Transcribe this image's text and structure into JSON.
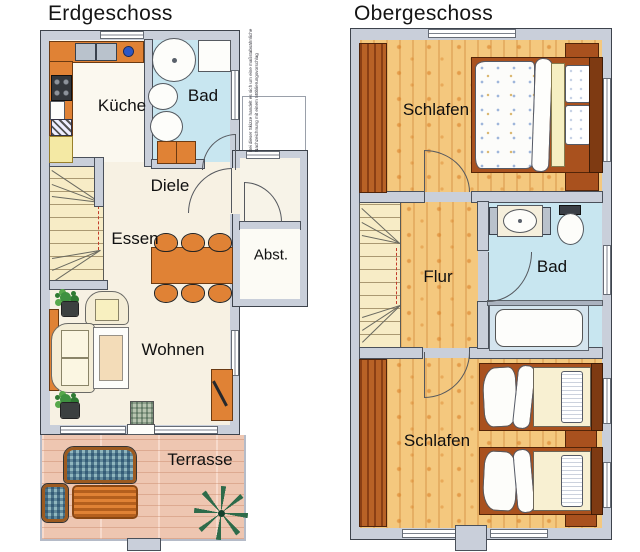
{
  "erdgeschoss": {
    "title": "Erdgeschoss",
    "rooms": {
      "kueche": "Küche",
      "bad": "Bad",
      "diele": "Diele",
      "essen": "Essen",
      "abstellraum": "Abst.",
      "wohnen": "Wohnen",
      "terrasse": "Terrasse"
    },
    "note": {
      "line1": "Bei dieser Skizze handelt es sich um eine maßstabsähnliche",
      "line2": "Nachzeichnung mit einem Möblierungsvorschlag"
    }
  },
  "obergeschoss": {
    "title": "Obergeschoss",
    "rooms": {
      "schlafen_oben": "Schlafen",
      "flur": "Flur",
      "bad": "Bad",
      "schlafen_unten": "Schlafen"
    }
  },
  "colors": {
    "wall": "#c9cfda",
    "wood_floor": "#f4c87e",
    "bath_floor": "#c8e6f0",
    "terrace_floor": "#eec6b1",
    "furniture_orange": "#e08235",
    "wardrobe_brown": "#b05a20",
    "stair_yellow": "#f7ecc6"
  }
}
